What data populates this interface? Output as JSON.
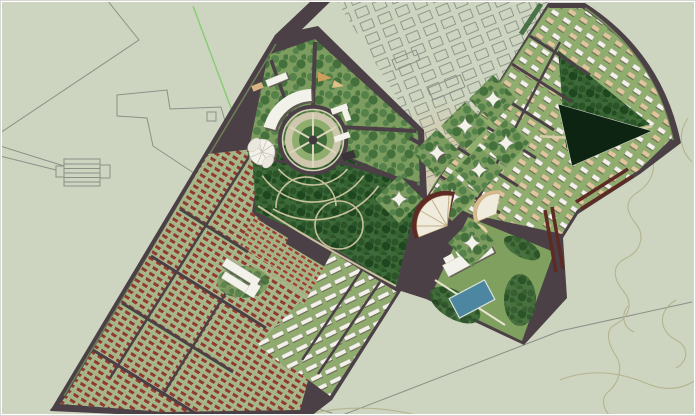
{
  "artifact": {
    "kind": "urban-master-plan-aerial-rendering",
    "canvas_width": 696,
    "canvas_height": 416
  },
  "palette": {
    "background": "#cdd5c0",
    "frame": "#ffffff",
    "cadastral_line": "#8b9187",
    "contour_line": "#b3b08a",
    "survey_green_line": "#79cb63",
    "road": "#4b4046",
    "road_median_green": "#7c9b5e",
    "block_green": "#8fae6e",
    "lawn_green": "#7d9c5f",
    "tree_dark": "#2b5429",
    "tree_canopy_base": "#3e6a39",
    "housing_roof_red": "#93402f",
    "housing_block_ground": "#a2b784",
    "rowhouse_ground": "#9db37c",
    "building_white": "#f2f1ea",
    "building_tan": "#dfc69b",
    "plaza_ring": "#cec7ad",
    "plaza_lawn": "#3f6b39",
    "path_tan": "#d8cda9",
    "water_dark": "#0c2411",
    "pool_blue": "#4d86a0",
    "red_slab_building": "#5d2a24",
    "village_ground_tint": "#d9c5a0",
    "resort_green": "#7fa05e",
    "shadow": "#5e5a52"
  },
  "zones": [
    {
      "id": "existing-village-grid"
    },
    {
      "id": "industrial-cadastral-outlines"
    },
    {
      "id": "residential-housing-district"
    },
    {
      "id": "rowhouse-clusters"
    },
    {
      "id": "civic-plaza-district"
    },
    {
      "id": "circular-plaza"
    },
    {
      "id": "amphitheater-building"
    },
    {
      "id": "flower-landmark-building"
    },
    {
      "id": "school-building"
    },
    {
      "id": "central-park"
    },
    {
      "id": "apartment-slab-district"
    },
    {
      "id": "tower-diamond-blocks"
    },
    {
      "id": "fan-auditorium-buildings"
    },
    {
      "id": "resort-diamond-with-pool"
    },
    {
      "id": "northeast-villa-district"
    },
    {
      "id": "water-basin"
    },
    {
      "id": "hillside-contours"
    }
  ]
}
